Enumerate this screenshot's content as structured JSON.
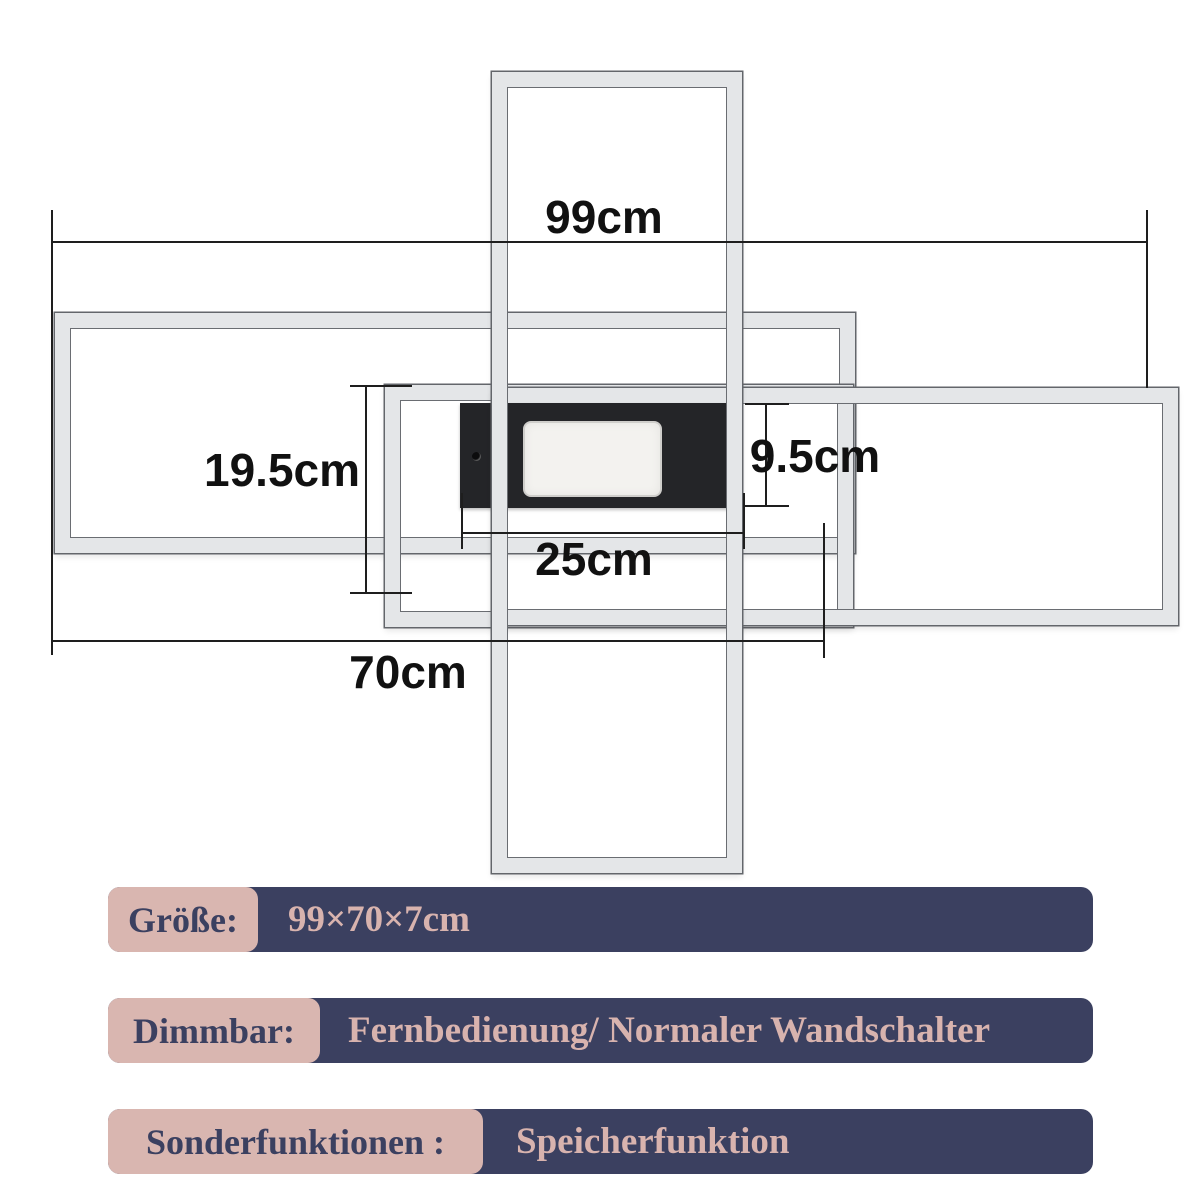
{
  "diagram": {
    "dimensions": {
      "total_width": "99cm",
      "middle_frame_height": "19.5cm",
      "housing_height": "9.5cm",
      "housing_width": "25cm",
      "left_frame_width": "70cm"
    },
    "colors": {
      "frame_gray": "#e4e6e8",
      "frame_outline": "#63666b",
      "housing_black": "#242528",
      "led_white": "#f3f2ef",
      "dimension_line": "#1e1e1e"
    }
  },
  "specs": [
    {
      "label": "Größe:",
      "value": "99×70×7cm"
    },
    {
      "label": "Dimmbar:",
      "value": "Fernbedienung/ Normaler Wandschalter"
    },
    {
      "label": "Sonderfunktionen :",
      "value": "Speicherfunktion"
    }
  ],
  "spec_colors": {
    "label_bg_pink": "#d9b6b0",
    "bar_bg_navy": "#3b4060"
  }
}
